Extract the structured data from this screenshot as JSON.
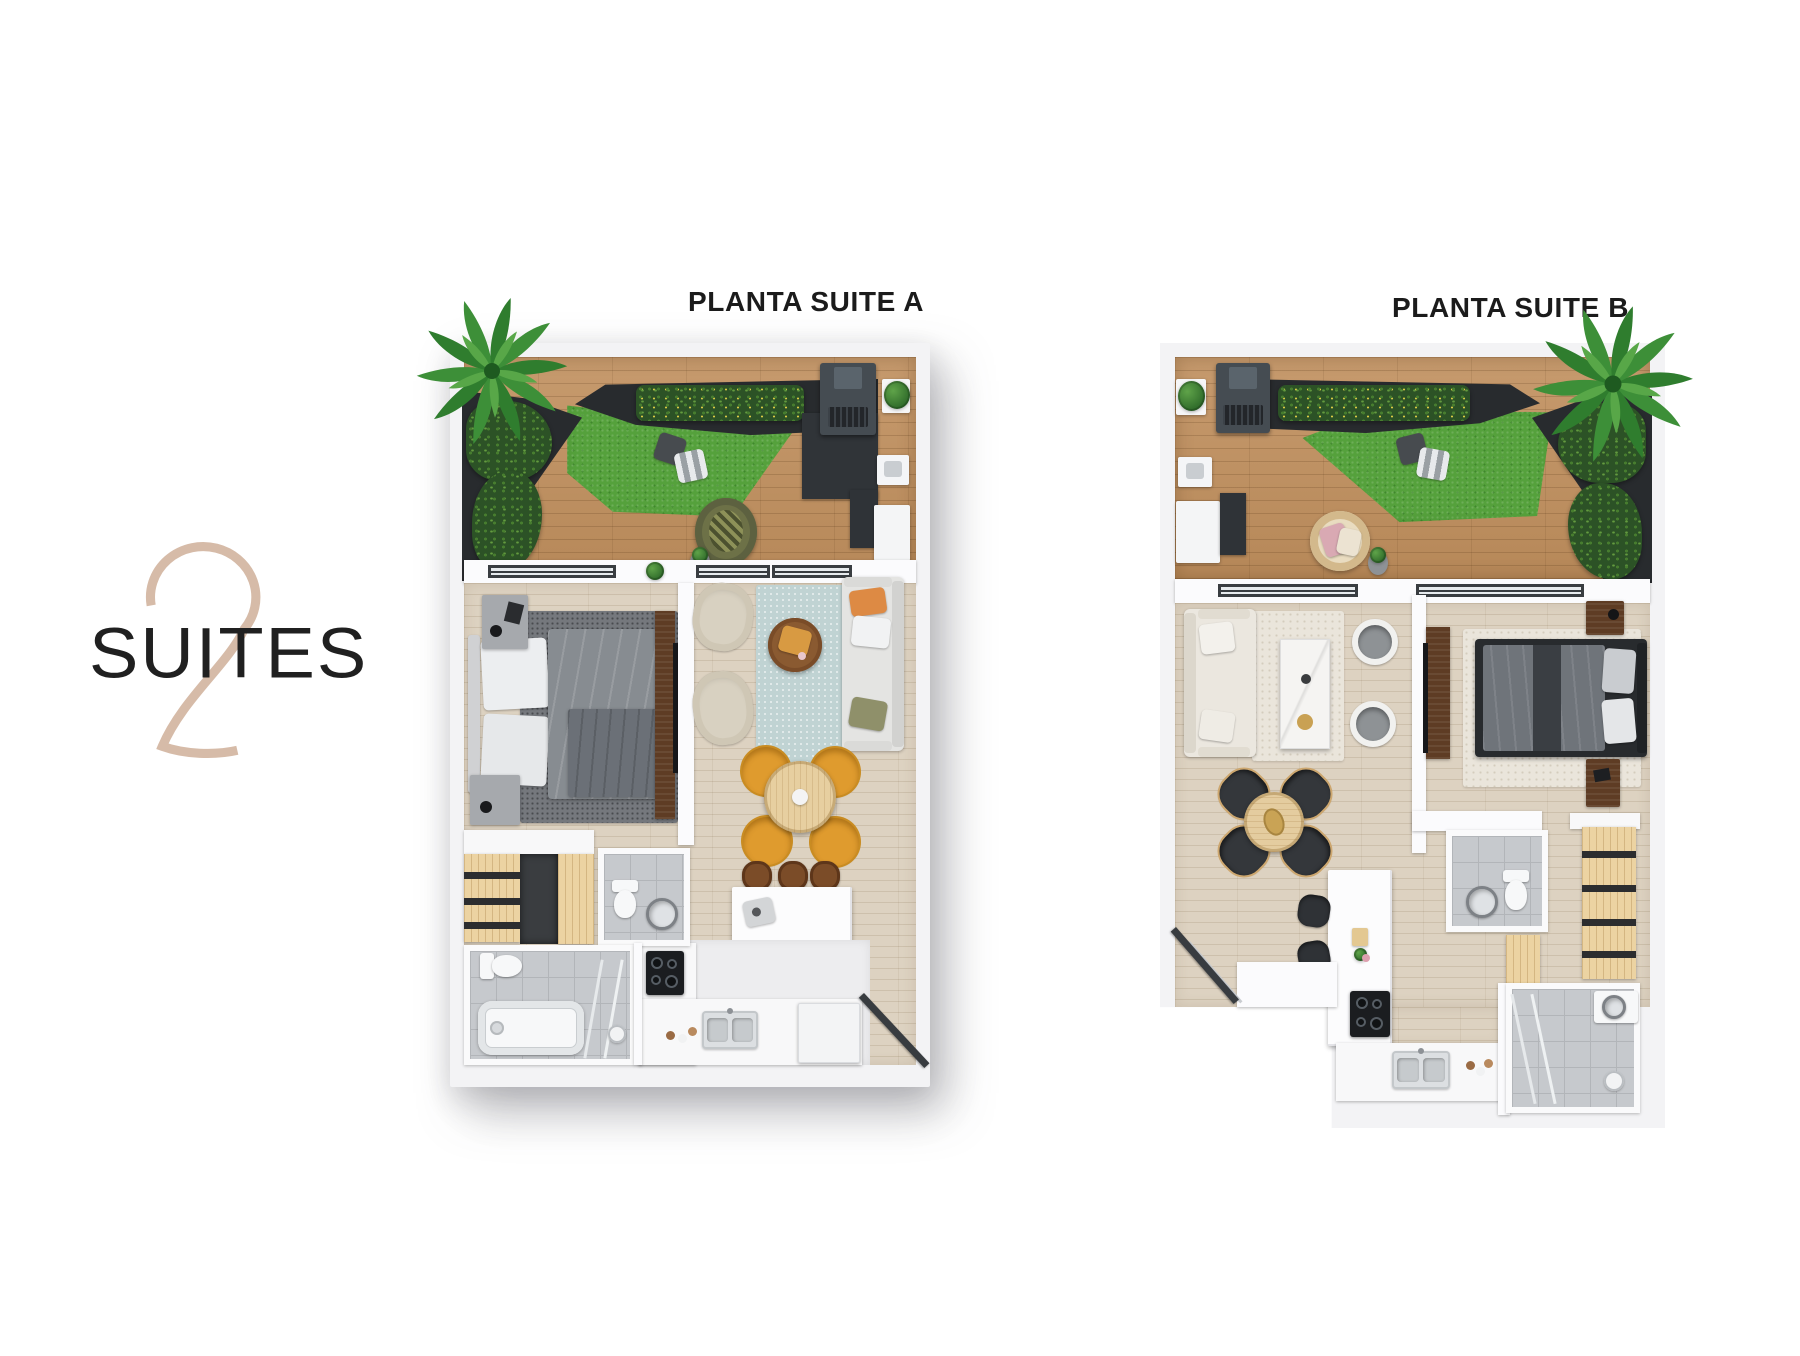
{
  "watermark": {
    "number": "2",
    "label": "SUITES"
  },
  "plans": [
    {
      "id": "suite-a",
      "title": "PLANTA SUITE A"
    },
    {
      "id": "suite-b",
      "title": "PLANTA SUITE B"
    }
  ],
  "palette": {
    "accent_beige": "#d6bba8",
    "text_dark": "#1b1b1b",
    "grass_green": "#55a13c",
    "hedge_green": "#2c5226",
    "deck_wood": "#c08f5d",
    "interior_wood": "#ddd2c1",
    "planter_charcoal": "#282b2e",
    "wall_white": "#f3f3f5"
  }
}
